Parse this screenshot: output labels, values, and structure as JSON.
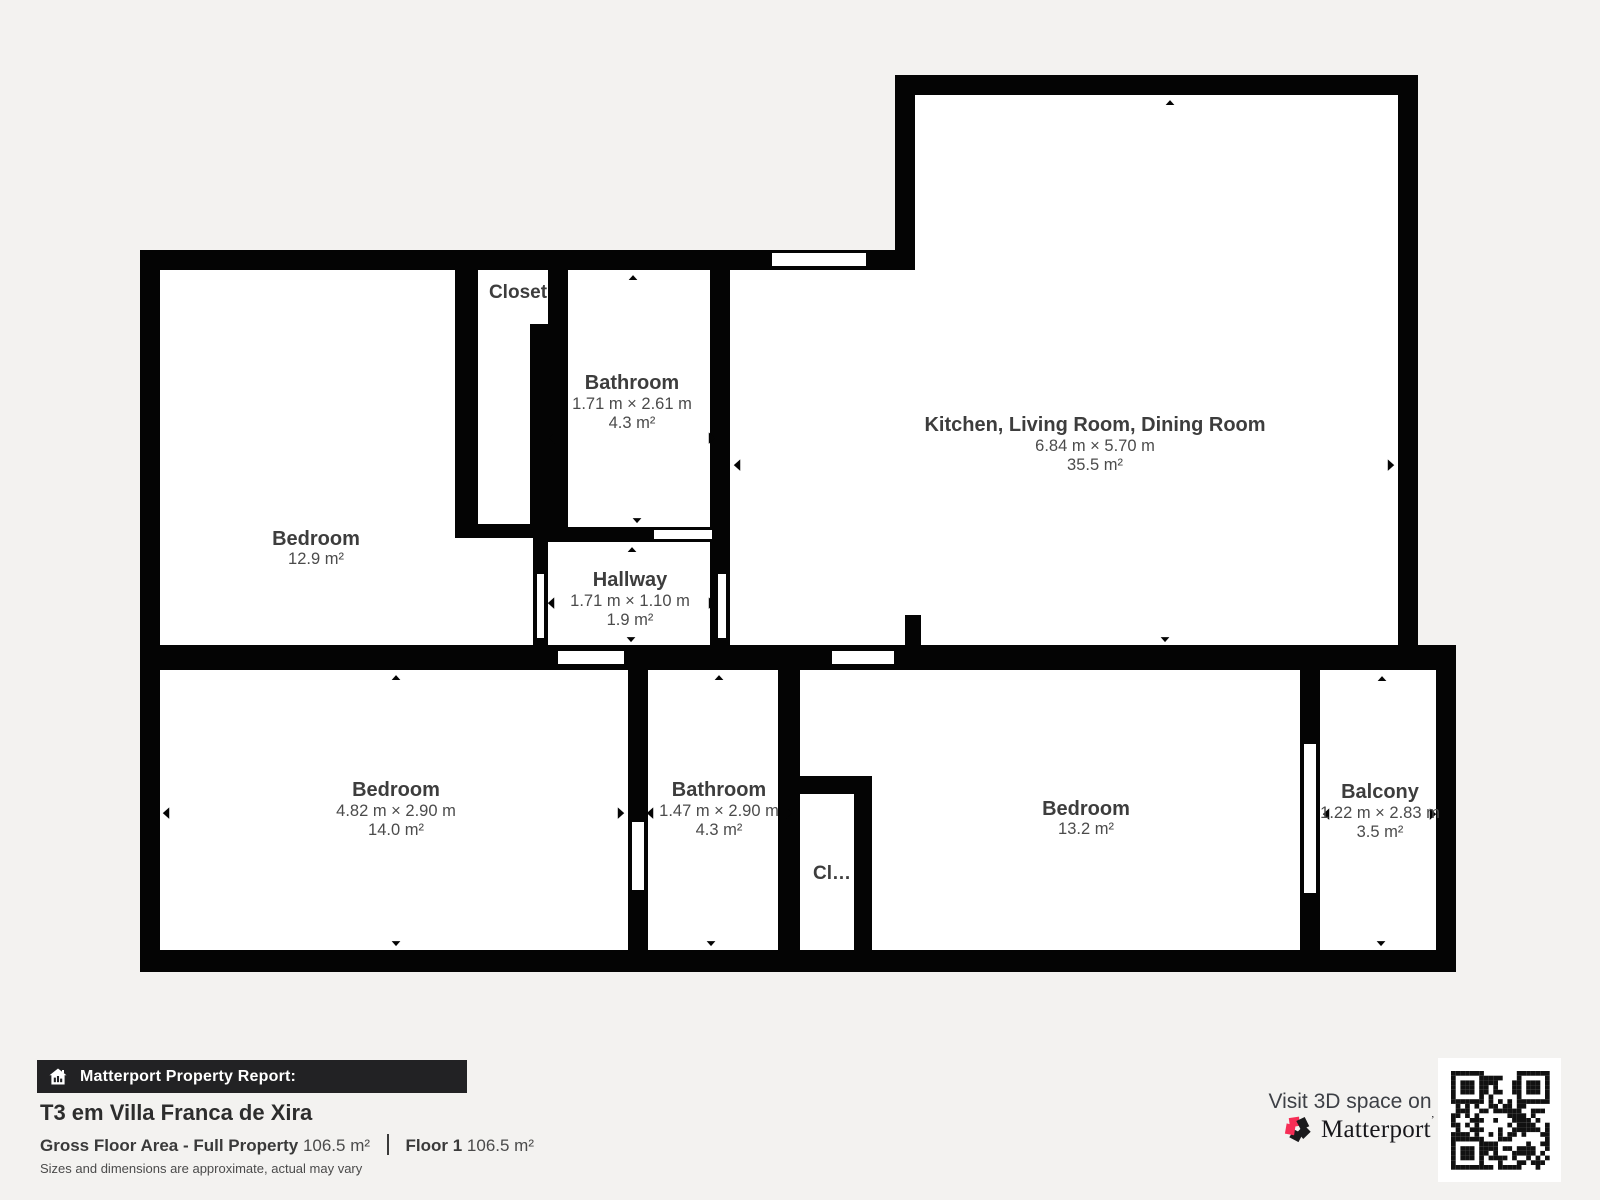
{
  "rooms": [
    {
      "id": "bedroom-top-left",
      "name": "Bedroom",
      "area": "12.9 m²"
    },
    {
      "id": "closet-top",
      "name": "Closet"
    },
    {
      "id": "bathroom-top",
      "name": "Bathroom",
      "dims": "1.71 m × 2.61 m",
      "area": "4.3 m²"
    },
    {
      "id": "hallway",
      "name": "Hallway",
      "dims": "1.71 m × 1.10 m",
      "area": "1.9 m²"
    },
    {
      "id": "kitchen-living-dining",
      "name": "Kitchen, Living Room, Dining Room",
      "dims": "6.84 m × 5.70 m",
      "area": "35.5 m²"
    },
    {
      "id": "bedroom-bottom-left",
      "name": "Bedroom",
      "dims": "4.82 m × 2.90 m",
      "area": "14.0 m²"
    },
    {
      "id": "bathroom-bottom",
      "name": "Bathroom",
      "dims": "1.47 m × 2.90 m",
      "area": "4.3 m²"
    },
    {
      "id": "closet-bottom",
      "name": "Cl…"
    },
    {
      "id": "bedroom-bottom-right",
      "name": "Bedroom",
      "area": "13.2 m²"
    },
    {
      "id": "balcony",
      "name": "Balcony",
      "dims": "1.22 m × 2.83 m",
      "area": "3.5 m²"
    }
  ],
  "footer": {
    "report_label": "Matterport Property Report:",
    "title": "T3 em Villa Franca de Xira",
    "gross_label": "Gross Floor Area - Full Property",
    "gross_value": "106.5 m²",
    "floor_label": "Floor 1",
    "floor_value": "106.5 m²",
    "disclaimer": "Sizes and dimensions are approximate, actual may vary",
    "visit_text": "Visit 3D space on",
    "brand": "Matterport",
    "brand_mark": "’"
  },
  "colors": {
    "background": "#f3f2f0",
    "wall": "#040404",
    "room_fill": "#ffffff",
    "brand_pink": "#f62e56",
    "footer_bar": "#222224"
  }
}
